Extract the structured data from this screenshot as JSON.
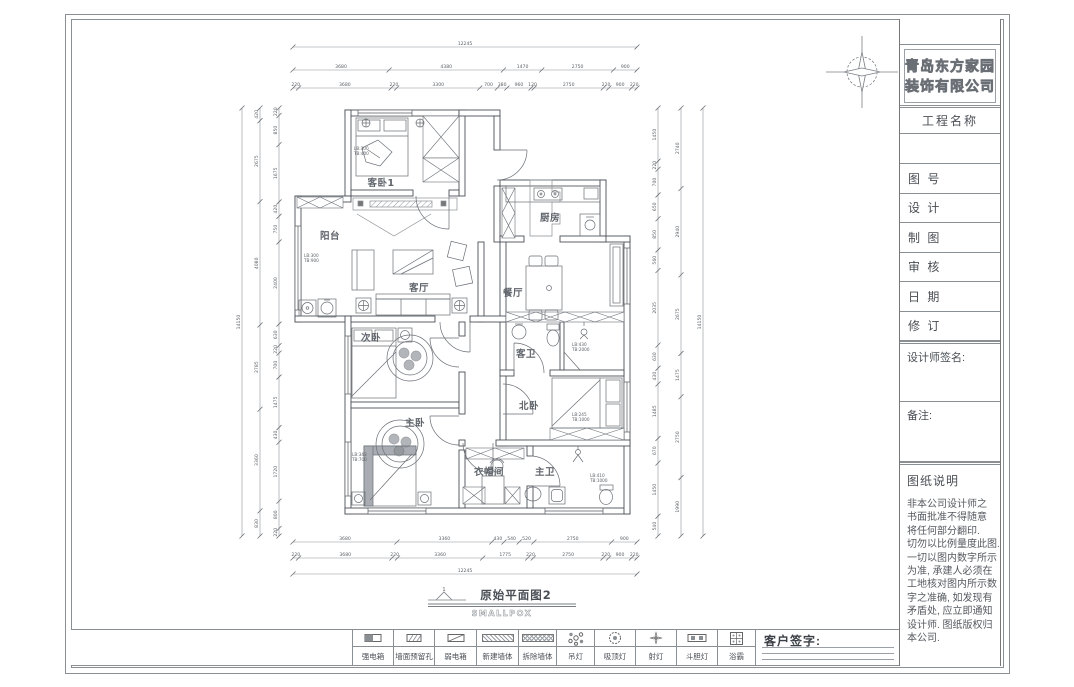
{
  "colors": {
    "line": "#555a60",
    "light_line": "#9aa0a6",
    "text": "#4a4f55",
    "wall": "#4b5057"
  },
  "sheet": {
    "company_name_line1": "青岛东方家园",
    "company_name_line2": "装饰有限公司",
    "titleblock": {
      "project_label": "工程名称",
      "rows": [
        "图 号",
        "设 计",
        "制 图",
        "审 核",
        "日 期",
        "修 订"
      ],
      "signature_label": "设计师签名:",
      "remark_label": "备注:",
      "notes_title": "图纸说明",
      "notes_lines": [
        "非本公司设计师之",
        "书面批准不得随意",
        "将任何部分翻印.",
        "切勿以比例量度此图.",
        "一切以图内数字所示",
        "为准, 承建人必须在",
        "工地核对图内所示数",
        "字之准确, 如发现有",
        "矛盾处, 应立即通知",
        "设计师. 图纸版权归",
        "本公司."
      ]
    },
    "customer_sign_label": "客户签字:"
  },
  "legend": {
    "items": [
      {
        "label": "强电箱",
        "icon": "strong-electric-box"
      },
      {
        "label": "墙面预留孔",
        "icon": "wall-hole"
      },
      {
        "label": "弱电箱",
        "icon": "weak-electric-box"
      },
      {
        "label": "新建墙体",
        "icon": "new-wall"
      },
      {
        "label": "拆除墙体",
        "icon": "demolish-wall"
      },
      {
        "label": "吊灯",
        "icon": "pendant-light"
      },
      {
        "label": "吸顶灯",
        "icon": "ceiling-light"
      },
      {
        "label": "射灯",
        "icon": "spot-light"
      },
      {
        "label": "斗胆灯",
        "icon": "recessed-light"
      },
      {
        "label": "浴霸",
        "icon": "bath-heater"
      }
    ]
  },
  "plan": {
    "caption_title": "原始平面图2",
    "caption_sub": "SMALLPOX",
    "detail_marker": "1",
    "rooms": [
      {
        "label": "客卧1"
      },
      {
        "label": "阳台"
      },
      {
        "label": "客厅"
      },
      {
        "label": "厨房"
      },
      {
        "label": "餐厅"
      },
      {
        "label": "次卧"
      },
      {
        "label": "客卫"
      },
      {
        "label": "北卧"
      },
      {
        "label": "主卧"
      },
      {
        "label": "衣帽间"
      },
      {
        "label": "主卫"
      }
    ],
    "annotations": [
      {
        "l1": "LB:300",
        "l2": "TB:400"
      },
      {
        "l1": "LB:300",
        "l2": "TB:900"
      },
      {
        "l1": "LB:430",
        "l2": "TB:2000"
      },
      {
        "l1": "LB:245",
        "l2": "TB:1000"
      },
      {
        "l1": "LB:343",
        "l2": "TB:700"
      },
      {
        "l1": "LB:410",
        "l2": "TB:1000"
      }
    ]
  },
  "dimensions": {
    "top": [
      [
        "12245"
      ],
      [
        3680,
        4380,
        1470,
        2750,
        900
      ],
      [
        220,
        3680,
        220,
        3300,
        700,
        380,
        960,
        120,
        2750,
        220,
        900,
        220
      ]
    ],
    "bottom": [
      [
        3680,
        3360,
        430,
        540,
        520,
        2750,
        900
      ],
      [
        220,
        3680,
        220,
        3360,
        1775,
        220,
        2750,
        220,
        900,
        220
      ],
      [
        "12245"
      ]
    ],
    "left": [
      [
        "14150"
      ],
      [
        420,
        2675,
        4080,
        2785,
        3360,
        830
      ],
      [
        220,
        850,
        1675,
        420,
        750,
        2400,
        630,
        220,
        700,
        1475,
        430,
        1720,
        800,
        220
      ]
    ],
    "right": [
      [
        1450,
        220,
        700,
        650,
        850,
        560,
        2035,
        630,
        430,
        1485,
        670,
        1450,
        540
      ],
      [
        2740,
        2940,
        2675,
        1475,
        2750,
        1990
      ],
      [
        "14150"
      ]
    ]
  }
}
